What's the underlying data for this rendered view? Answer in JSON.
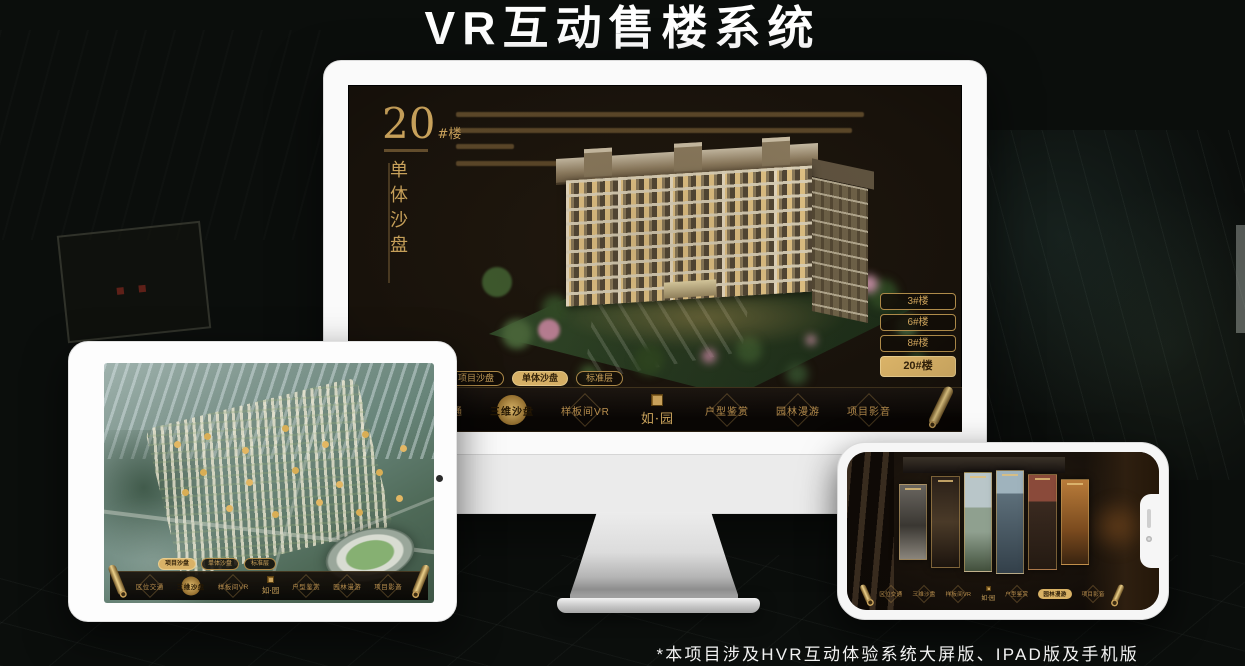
{
  "title": "VR互动售楼系统",
  "footnote": "*本项目涉及HVR互动体验系统大屏版、IPAD版及手机版",
  "brand": {
    "logo": "如·园"
  },
  "colors": {
    "gold": "#c9a25b",
    "gold_bright": "#d9b467",
    "screen_bg": "#18120b",
    "device_white": "#f6f6f6"
  },
  "icons": {
    "scroll": "gold-scroll-cylinder",
    "seal": "gold-square-seal",
    "camera": "front-camera-dot",
    "speaker": "earpiece-slot"
  },
  "monitor": {
    "heading": {
      "number": "20",
      "suffix": "#楼",
      "subtitle_vertical": "单体沙盘"
    },
    "floor_buttons": [
      {
        "label": "3#楼",
        "active": false
      },
      {
        "label": "6#楼",
        "active": false
      },
      {
        "label": "8#楼",
        "active": false
      },
      {
        "label": "20#楼",
        "active": true
      }
    ],
    "tabs": [
      {
        "label": "项目沙盘",
        "active": false
      },
      {
        "label": "单体沙盘",
        "active": true
      },
      {
        "label": "标准层",
        "active": false
      }
    ],
    "nav": [
      {
        "label": "区位交通",
        "active": false
      },
      {
        "label": "三维沙盘",
        "active": true
      },
      {
        "label": "样板间VR",
        "active": false
      },
      {
        "label": "户型鉴赏",
        "active": false
      },
      {
        "label": "园林漫游",
        "active": false
      },
      {
        "label": "项目影音",
        "active": false
      }
    ]
  },
  "tablet": {
    "tabs": [
      {
        "label": "项目沙盘",
        "active": true
      },
      {
        "label": "单体沙盘",
        "active": false
      },
      {
        "label": "标准层",
        "active": false
      }
    ],
    "nav": [
      {
        "label": "区位交通",
        "active": false
      },
      {
        "label": "三维沙盘",
        "active": true
      },
      {
        "label": "样板间VR",
        "active": false
      },
      {
        "label": "户型鉴赏",
        "active": false
      },
      {
        "label": "园林漫游",
        "active": false
      },
      {
        "label": "项目影音",
        "active": false
      }
    ]
  },
  "phone": {
    "nav": [
      {
        "label": "区位交通",
        "active": false
      },
      {
        "label": "三维沙盘",
        "active": false
      },
      {
        "label": "样板间VR",
        "active": false
      },
      {
        "label": "户型鉴赏",
        "active": false
      },
      {
        "label": "园林漫游",
        "active": true
      },
      {
        "label": "项目影音",
        "active": false
      }
    ]
  }
}
